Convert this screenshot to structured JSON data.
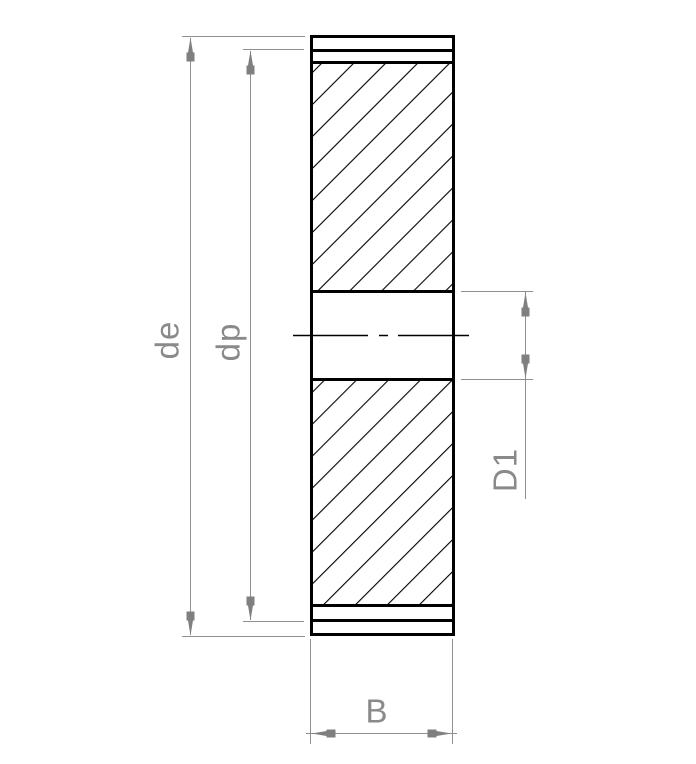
{
  "drawing": {
    "kind": "gear cross-section technical drawing",
    "dimensions": {
      "outside_diameter": {
        "label": "de"
      },
      "pitch_diameter": {
        "label": "dp"
      },
      "bore_diameter": {
        "label": "D1"
      },
      "face_width": {
        "label": "B"
      }
    },
    "colors": {
      "background": "#ffffff",
      "outline": "#000000",
      "dimension_line": "#8f8f8f",
      "dimension_arrow": "#7f7f7f",
      "dimension_text": "#8a8a8a"
    }
  }
}
